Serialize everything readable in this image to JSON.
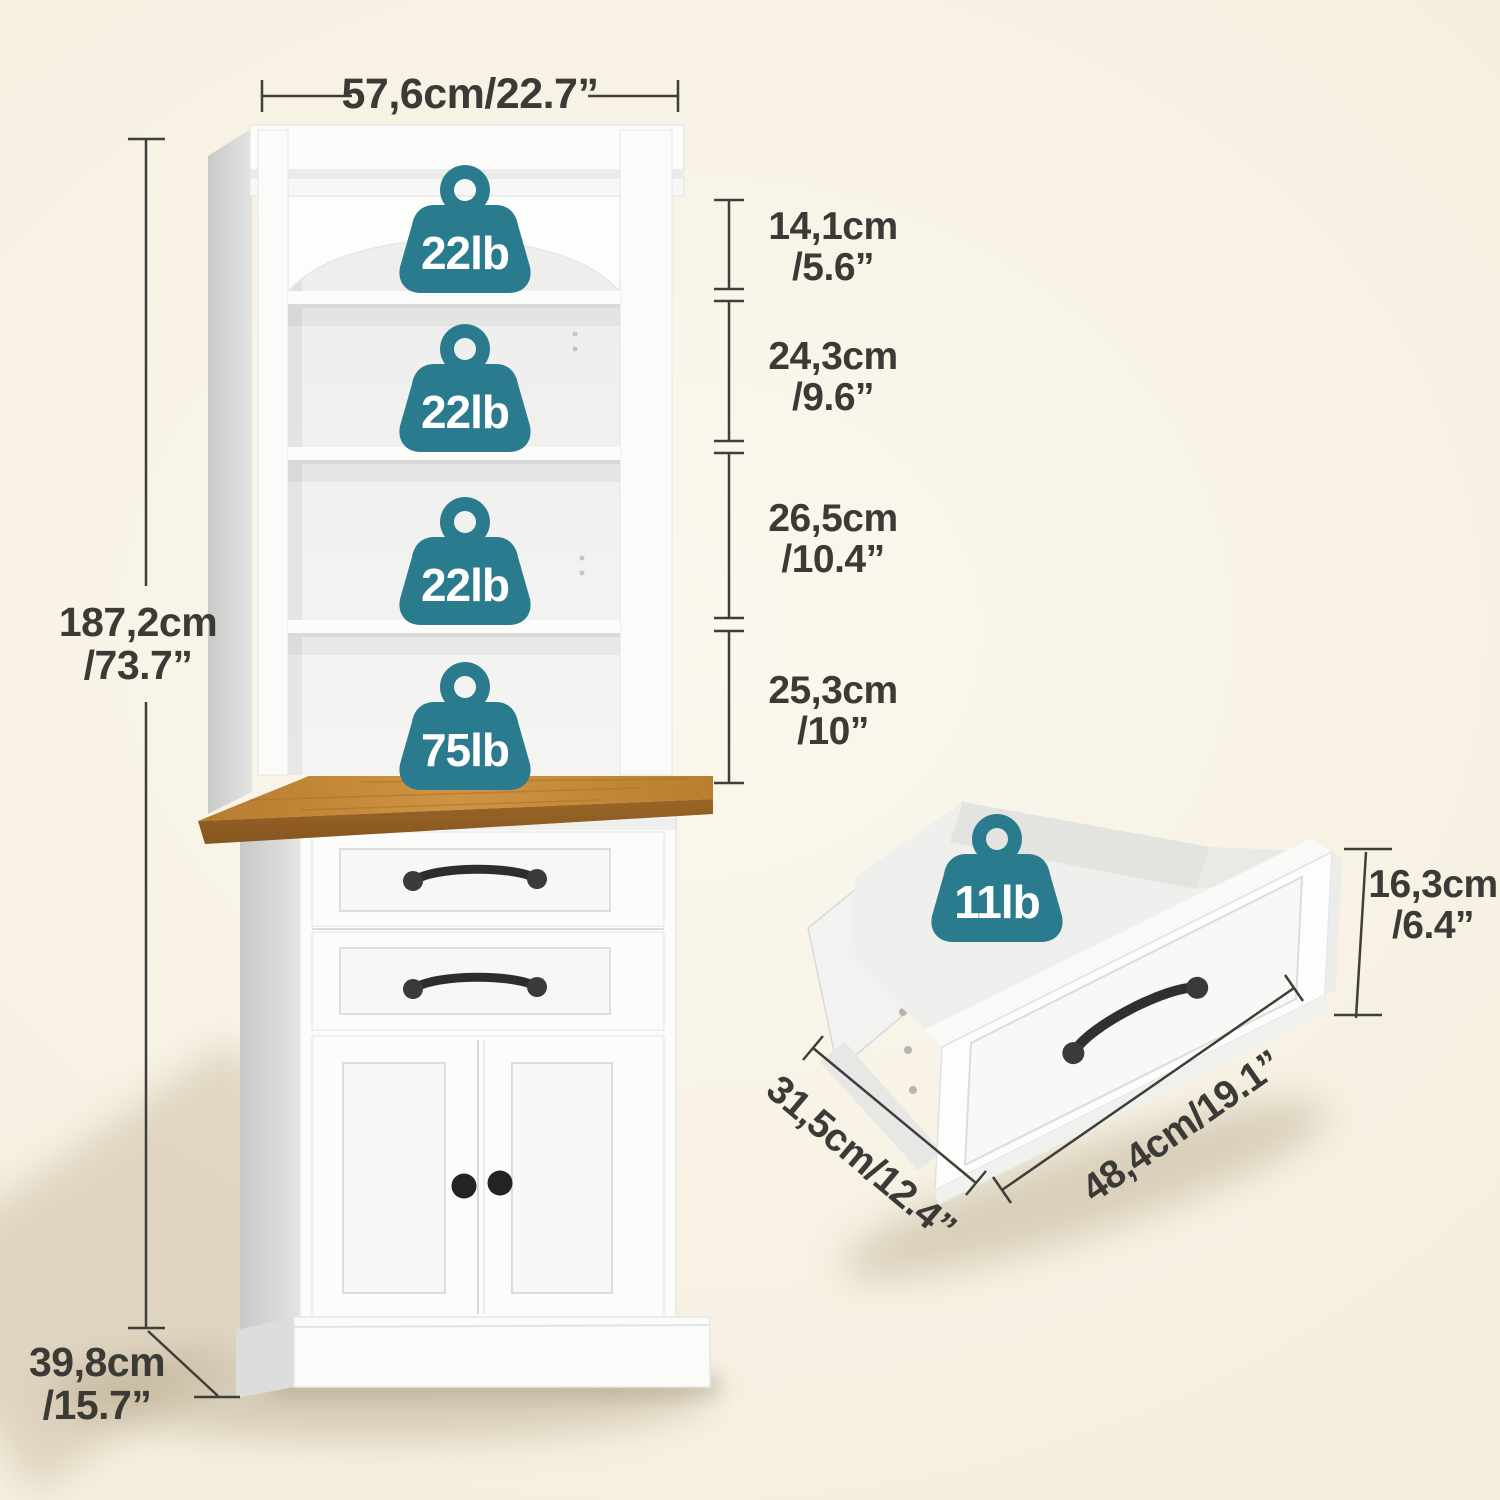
{
  "product": {
    "name": "bookcase-hutch-cabinet-dimension-diagram"
  },
  "colors": {
    "badge_teal": "#2a7b8d",
    "dim_line": "#3f3e3a",
    "dim_text": "#3b3a36",
    "background_cream": "#f7f1e2",
    "wood_top": "#c08438",
    "cabinet_white": "#fcfcfb"
  },
  "weights": {
    "shelf1": "22lb",
    "shelf2": "22lb",
    "shelf3": "22lb",
    "countertop": "75lb",
    "drawer": "11lb"
  },
  "dimensions": {
    "overall_width": "57,6cm/22.7”",
    "overall_height_cm": "187,2cm",
    "overall_height_in": "/73.7”",
    "overall_depth_cm": "39,8cm",
    "overall_depth_in": "/15.7”",
    "shelf_gaps": [
      {
        "cm": "14,1cm",
        "in": "/5.6”"
      },
      {
        "cm": "24,3cm",
        "in": "/9.6”"
      },
      {
        "cm": "26,5cm",
        "in": "/10.4”"
      },
      {
        "cm": "25,3cm",
        "in": "/10”"
      }
    ],
    "drawer_height_cm": "16,3cm",
    "drawer_height_in": "/6.4”",
    "drawer_depth": "31,5cm/12.4”",
    "drawer_width": "48,4cm/19.1”"
  }
}
